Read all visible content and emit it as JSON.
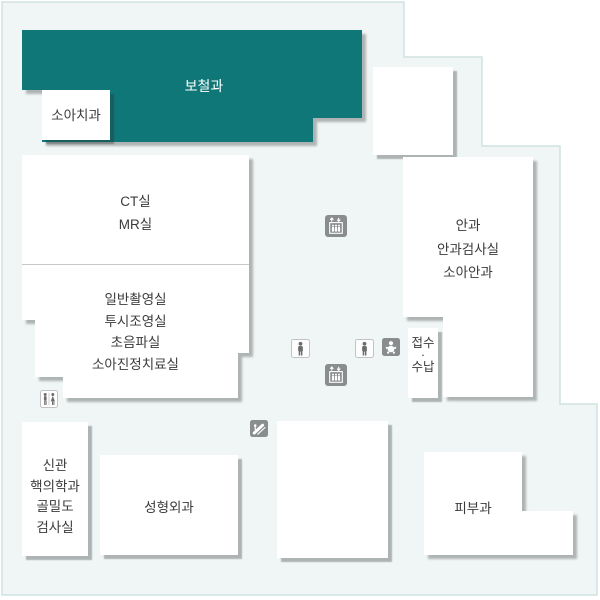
{
  "map": {
    "background_fill": "#f0f5f5",
    "border_color": "#cfe2e2",
    "highlight_color": "#0f7778",
    "icon_gray": "#898d8d",
    "shadow_color": "#a8adad"
  },
  "rooms": {
    "prosthodontics": {
      "label": "보철과",
      "highlighted": true
    },
    "pediatric_dentistry": {
      "label": "소아치과"
    },
    "imaging_upper": {
      "lines": [
        "CT실",
        "MR실"
      ]
    },
    "imaging_lower": {
      "lines": [
        "일반촬영실",
        "투시조영실",
        "초음파실",
        "소아진정치료실"
      ]
    },
    "ophthalmology": {
      "lines": [
        "안과",
        "안과검사실",
        "소아안과"
      ]
    },
    "reception": {
      "lines": [
        "접수",
        "·",
        "수납"
      ]
    },
    "annex_nuclear_medicine": {
      "lines": [
        "신관",
        "핵의학과",
        "골밀도",
        "검사실"
      ]
    },
    "plastic_surgery": {
      "label": "성형외과"
    },
    "dermatology": {
      "label": "피부과"
    }
  },
  "icons": {
    "elevator_upper": "elevator",
    "elevator_lower": "elevator",
    "restroom_single_left": "restroom-person",
    "restroom_single_right": "restroom-person",
    "nursing_room": "baby",
    "escalator": "escalator",
    "restroom_male_female": "male-female-restroom"
  }
}
